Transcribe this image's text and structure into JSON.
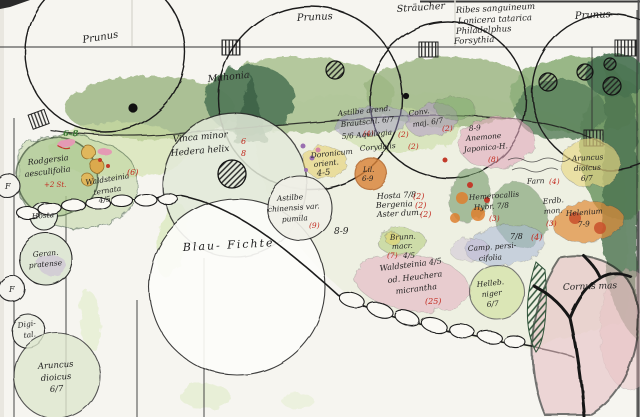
{
  "plan": {
    "trees": {
      "prunus_left": "Prunus",
      "prunus_center": "Prunus",
      "prunus_right": "Prunus",
      "blue_spruce": "Blau- Fichte",
      "cornus": "Cornus mas"
    },
    "shrubs": {
      "straeucher": "Sträucher",
      "mahonia": "Mahonia",
      "list": [
        "Ribes sanguineum",
        "Lonicera tatarica",
        "Philadelphus",
        "Forsythia"
      ]
    }
  },
  "beds": {
    "vinca": {
      "l1": "Vinca minor",
      "l2": "Hedera helix",
      "c1": "6",
      "c2": "8"
    },
    "range_6_8": "6-8",
    "rodgersia": {
      "l1": "Rodgersia",
      "l2": "aesculifolia",
      "count": "+2 St."
    },
    "waldsteinia_left": {
      "l1": "Waldsteinia",
      "l2": "ternata",
      "l3": "4/5",
      "count": "(6)"
    },
    "hosta": "Hosta",
    "fern_marks": [
      "F",
      "F"
    ],
    "geranium": {
      "l1": "Geran.",
      "l2": "pratense"
    },
    "digitalis": {
      "l1": "Digi-",
      "l2": "tal."
    },
    "aruncus_left": {
      "l1": "Aruncus",
      "l2": "dioicus",
      "l3": "6/7"
    },
    "astilbe_arendsii": {
      "l1": "Astilbe arend.",
      "l2": "Brautschl. 6/7",
      "count": "(4)"
    },
    "convallaria": {
      "l1": "Conv.",
      "l2": "maj. 6/7",
      "count": "(2)"
    },
    "aquilegia": {
      "l1": "5/6 Aquilegia",
      "count": "(2)"
    },
    "corydalis": {
      "l1": "Corydalis",
      "count": "(2)"
    },
    "doronicum": {
      "l1": "Doronicum",
      "l2": "orient.",
      "l3": "4-5"
    },
    "lilium": {
      "l1": "Lil.",
      "l2": "6-9"
    },
    "anemone_japonica": {
      "l1": "8-9",
      "l2": "Anemone",
      "l3": "Japonica-H.",
      "count": "(8)"
    },
    "astilbe_chinensis": {
      "l1": "Astilbe",
      "l2": "chinensis var.",
      "l3": "pumila",
      "count": "(9)"
    },
    "range_8_9": "8-9",
    "hosta78": {
      "l1": "Hosta 7/8",
      "count": "(2)"
    },
    "bergenia": {
      "l1": "Bergenia",
      "count": "(2)"
    },
    "aster": {
      "l1": "Aster dum.",
      "count": "(2)"
    },
    "brunnera": {
      "l1": "Brunn.",
      "l2": "macr.",
      "l3": "4/5",
      "count": "(7)"
    },
    "waldsteinia_heuchera": {
      "l1": "Waldsteinia 4/5",
      "l2": "od. Heuchera",
      "l3": "micrantha",
      "count": "(25)"
    },
    "hemerocallis": {
      "l1": "Hemerocallis",
      "l2": "Hybr. 7/8",
      "count": "(3)"
    },
    "erdbeere": {
      "l1": "Erdb.",
      "l2": "mon.",
      "count": "(3)"
    },
    "campanula": {
      "l1": "7/8",
      "l2": "Camp. persi-",
      "l3": "cifolia",
      "count": "(4)"
    },
    "farn": {
      "l1": "Farn",
      "count": "(4)"
    },
    "helenium": {
      "l1": "Helenium",
      "l2": "7-9"
    },
    "aruncus_right": {
      "l1": "Aruncus",
      "l2": "dioicus",
      "l3": "6/7"
    },
    "helleborus": {
      "l1": "Helleb.",
      "l2": "niger",
      "l3": "6/7"
    }
  },
  "palette": {
    "paper": "#f6f5f0",
    "ink": "#1f1f1f",
    "annotation_red": "#c22a1f",
    "annotation_green": "#3d7a35",
    "foliage_dark": "#46704f",
    "foliage_mid": "#8fae7c",
    "foliage_light": "#cfe0a5",
    "bloom_pink": "#e2a9bd",
    "bloom_orange": "#dd8a3c",
    "bloom_yellow": "#e6d06e",
    "bloom_purple": "#b29ac9",
    "bloom_blue": "#a9b8d8"
  }
}
